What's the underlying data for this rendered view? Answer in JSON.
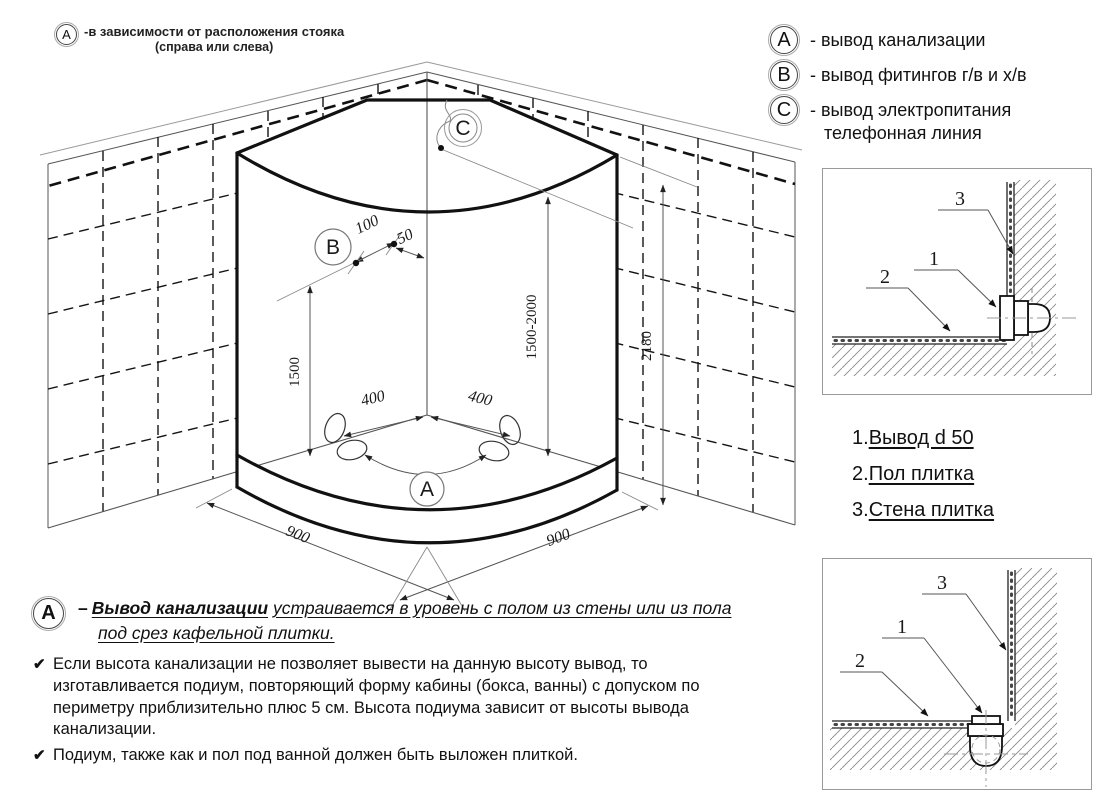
{
  "note_top_left": {
    "marker": "A",
    "line1": "-в зависимости от расположения стояка",
    "line2": "(справа или слева)"
  },
  "legend": {
    "items": [
      {
        "marker": "A",
        "text": "- вывод канализации"
      },
      {
        "marker": "B",
        "text": "- вывод фитингов г/в и х/в"
      },
      {
        "marker": "C",
        "text": "- вывод электропитания",
        "text2": "телефонная линия"
      }
    ]
  },
  "drawing": {
    "markers": {
      "a": "A",
      "b": "B",
      "c": "C"
    },
    "dims": {
      "width_left": "900",
      "width_right": "900",
      "height_inner_left": "1500",
      "height_outlet_range": "1500-2000",
      "height_wall": "2180",
      "floor_left": "400",
      "floor_right": "400",
      "fitting_spacing": "100",
      "fitting_corner_offset": "50"
    }
  },
  "details": {
    "callouts": {
      "one": "1",
      "two": "2",
      "three": "3"
    }
  },
  "parts_list": {
    "items": [
      {
        "num": "1.",
        "label": "Вывод d 50"
      },
      {
        "num": "2.",
        "label": "Пол плитка"
      },
      {
        "num": "3.",
        "label": "Стена плитка"
      }
    ]
  },
  "bottom_note": {
    "marker": "A",
    "dash": "–",
    "title": "Вывод канализации",
    "text": "устраивается в уровень с полом из стены или из пола",
    "text2": "под срез кафельной плитки.",
    "check": "✔",
    "bullet1": "Если высота канализации не позволяет вывести на данную высоту вывод, то изготавливается подиум, повторяющий форму кабины (бокса, ванны) с допуском по периметру приблизительно плюс 5 см. Высота подиума зависит от высоты вывода канализации.",
    "bullet2": "Подиум, также как и пол под ванной должен быть выложен плиткой."
  }
}
